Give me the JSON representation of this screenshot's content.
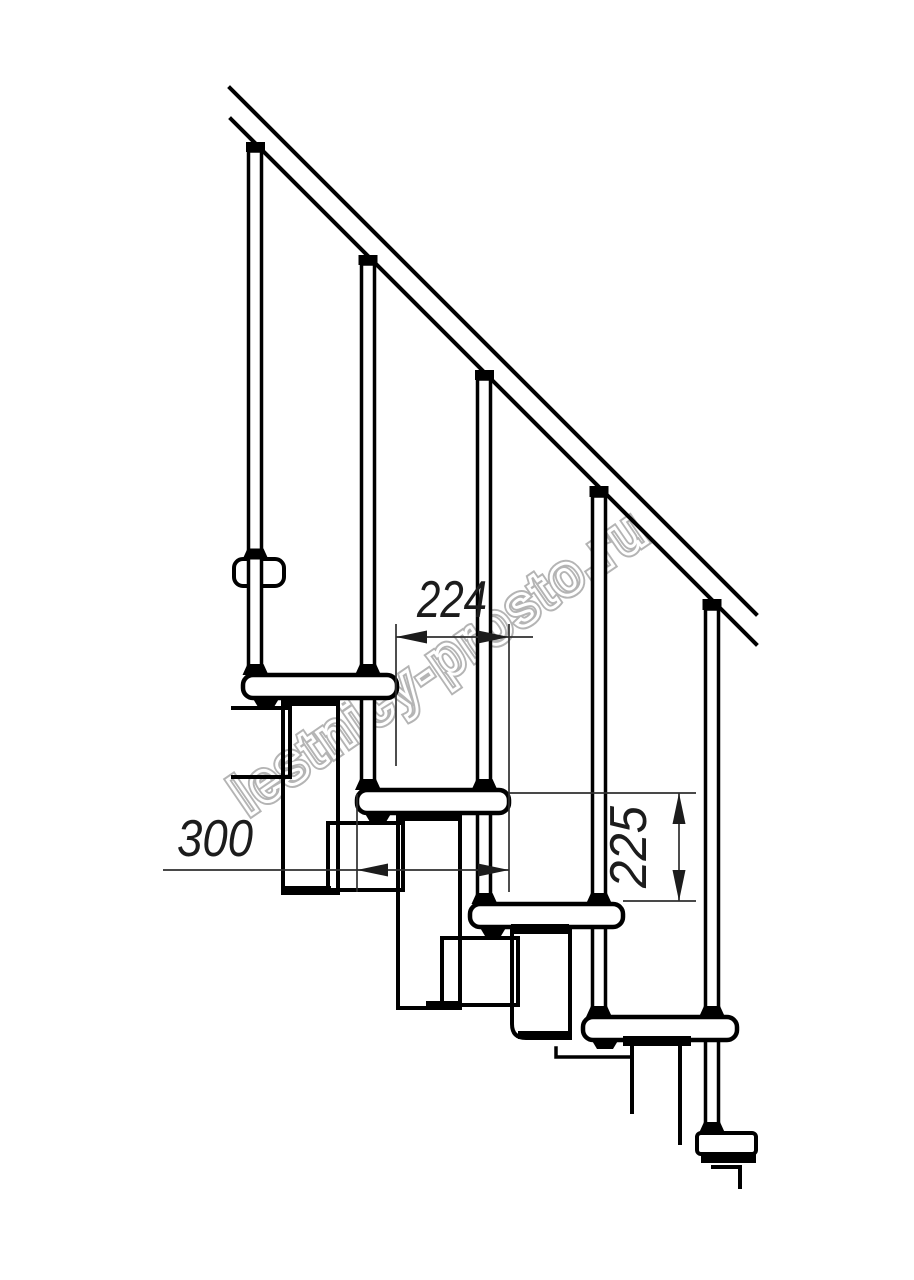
{
  "drawing": {
    "type": "technical side elevation of a modular staircase",
    "watermark": {
      "text": "lestnicy-prosto.ru"
    },
    "dimensions": {
      "going_label": "224",
      "tread_depth_label": "300",
      "rise_label": "225"
    },
    "counts": {
      "balusters": 5,
      "treads_side_view": 4,
      "treads_end_view": 1
    },
    "colors": {
      "background": "#ffffff",
      "line": "#000000",
      "dimension_line": "#2f2f2f",
      "dimension_text": "#1c1c1c",
      "watermark_outline": "#b4b4b4",
      "watermark_inner": "#ffffff"
    }
  }
}
